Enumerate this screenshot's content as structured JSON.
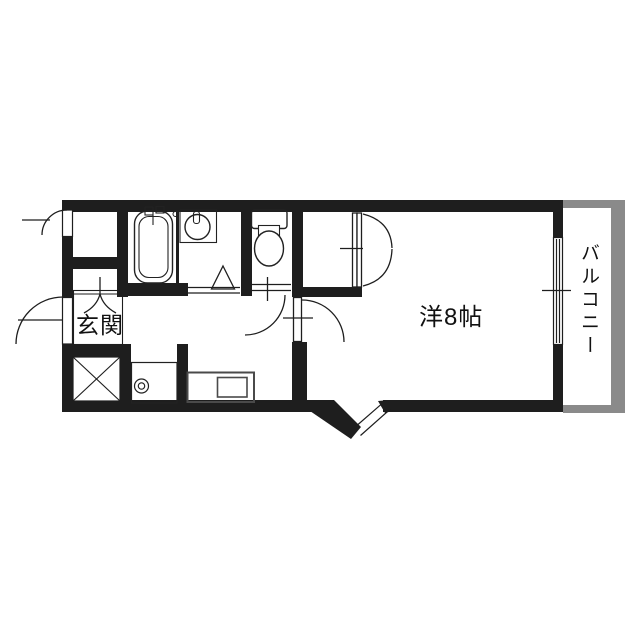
{
  "floorplan": {
    "labels": {
      "entrance": "玄関",
      "main_room": "洋8帖",
      "balcony": "バルコニー"
    },
    "colors": {
      "wall": "#1e1e1e",
      "balcony_wall": "#8a8a8a",
      "line": "#1e1e1e",
      "background": "#ffffff"
    },
    "symbols": {
      "bathtub": "bathtub-icon",
      "wash_basin": "wash-basin-icon",
      "toilet": "toilet-icon",
      "closet_double_doors": "double-door-icon",
      "kitchen_counter": "kitchen-sink-icon",
      "washing_machine_pan": "washer-pan-icon",
      "shaft": "crossed-box-icon",
      "door_swings": "door-arc-icon",
      "sliding_window": "sliding-window-icon"
    }
  }
}
